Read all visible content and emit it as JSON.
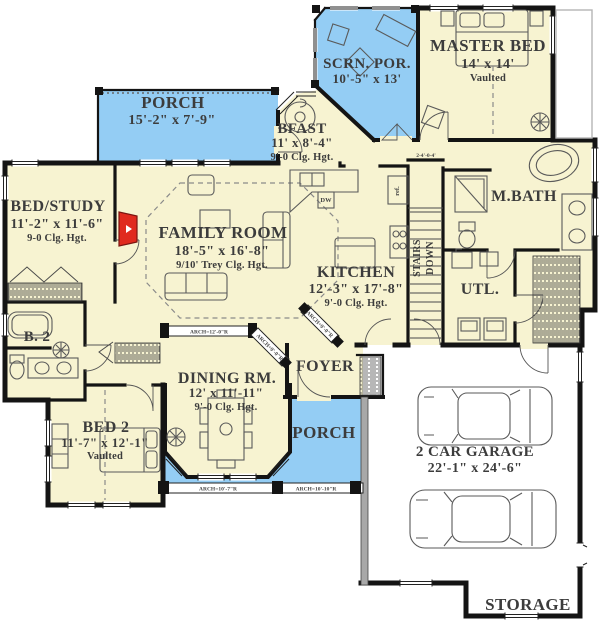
{
  "colors": {
    "room_fill": "#f7f3d1",
    "porch_fill": "#94cdf4",
    "wall": "#141414",
    "accent_red": "#e02a1e",
    "text": "#3c3c3c"
  },
  "rooms": {
    "porch_top": {
      "name": "PORCH",
      "dims": "15'-2\" x 7'-9\""
    },
    "scrn_por": {
      "name": "SCRN. POR.",
      "dims": "10'-5\" x 13'"
    },
    "master": {
      "name": "MASTER BED",
      "dims": "14' x 14'",
      "note": "Vaulted"
    },
    "bfast": {
      "name": "BFAST",
      "dims": "11' x 8'-4\"",
      "note": "9'-0 Clg. Hgt."
    },
    "bed_study": {
      "name": "BED/STUDY",
      "dims": "11'-2\" x 11'-6\"",
      "note": "9-0 Clg. Hgt."
    },
    "family": {
      "name": "FAMILY ROOM",
      "dims": "18'-5\" x 16'-8\"",
      "note": "9/10' Trey Clg. Hgt."
    },
    "kitchen": {
      "name": "KITCHEN",
      "dims": "12'-3\" x 17'-8\"",
      "note": "9'-0 Clg. Hgt."
    },
    "mbath": {
      "name": "M.BATH"
    },
    "stairs": {
      "line1": "STAIRS",
      "line2": "DOWN"
    },
    "utl": {
      "name": "UTL."
    },
    "b2": {
      "name": "B. 2"
    },
    "bed2": {
      "name": "BED 2",
      "dims": "11'-7\" x 12'-1\"",
      "note": "Vaulted"
    },
    "dining": {
      "name": "DINING RM.",
      "dims": "12' x 11'-11\"",
      "note": "9'-0 Clg. Hgt."
    },
    "foyer": {
      "name": "FOYER"
    },
    "porch_bottom": {
      "name": "PORCH"
    },
    "garage": {
      "name": "2 CAR GARAGE",
      "dims": "22'-1\" x 24'-6\""
    },
    "storage": {
      "name": "STORAGE"
    }
  },
  "annotations": {
    "arch_hall": "ARCH=12'-0\"R",
    "arch_hall_diag": "ARCH=9'-0\"R",
    "arch_kitchen_diag": "ARCH=9'-0\"R",
    "porch_arch_1": "ARCH=10'-7\"R",
    "porch_arch_2": "ARCH=10'-10\"R",
    "stairs_dim": "2-4'-0-4'",
    "ref_label": "ref.",
    "dw_label": "DW"
  }
}
